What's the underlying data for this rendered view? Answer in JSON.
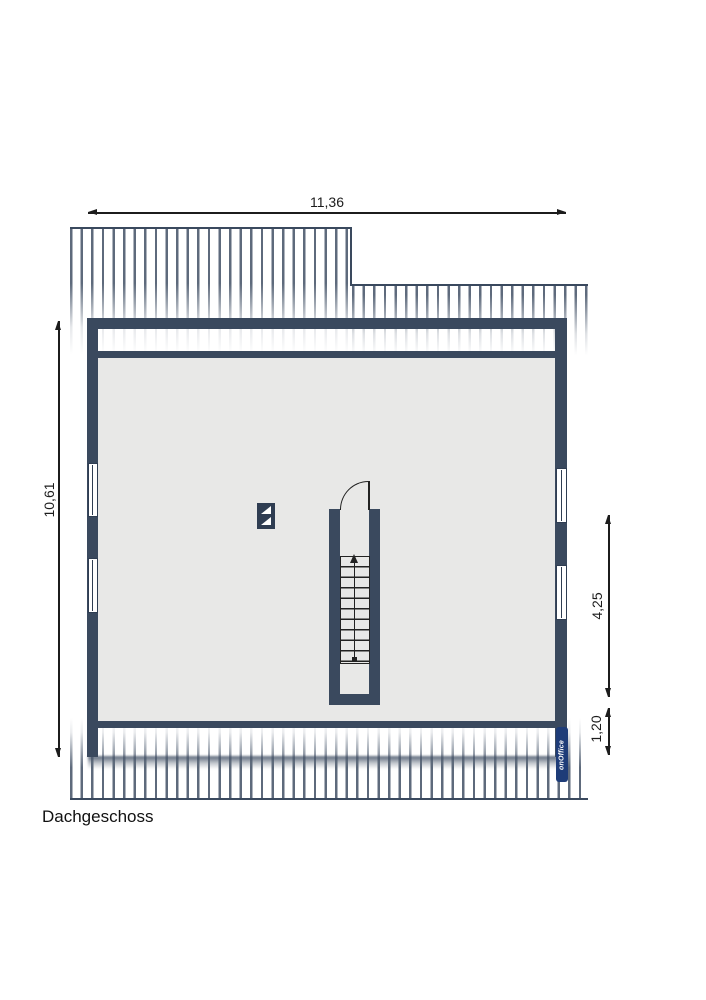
{
  "floor": {
    "label": "Dachgeschoss"
  },
  "dimensions": {
    "total_width_m": "11,36",
    "total_depth_m": "10,61",
    "right_upper_m": "4,25",
    "right_lower_m": "1,20"
  },
  "stairs": {
    "tread_count": 10,
    "direction_arrow": "up"
  },
  "windows": {
    "left_wall_count": 2,
    "right_wall_count": 2
  },
  "symbols": {
    "chimney": "chimney-symbol",
    "door": "door-swing-arc",
    "roof": "rafter-hatching"
  },
  "watermark": {
    "label": "onOffice"
  },
  "colors": {
    "wall": "#3a495e",
    "room_fill": "#e8e8e7",
    "stair_line": "#222222",
    "dimension_line": "#1c1c1c",
    "watermark_bg": "#1e3c78",
    "watermark_text": "#ffffff"
  }
}
